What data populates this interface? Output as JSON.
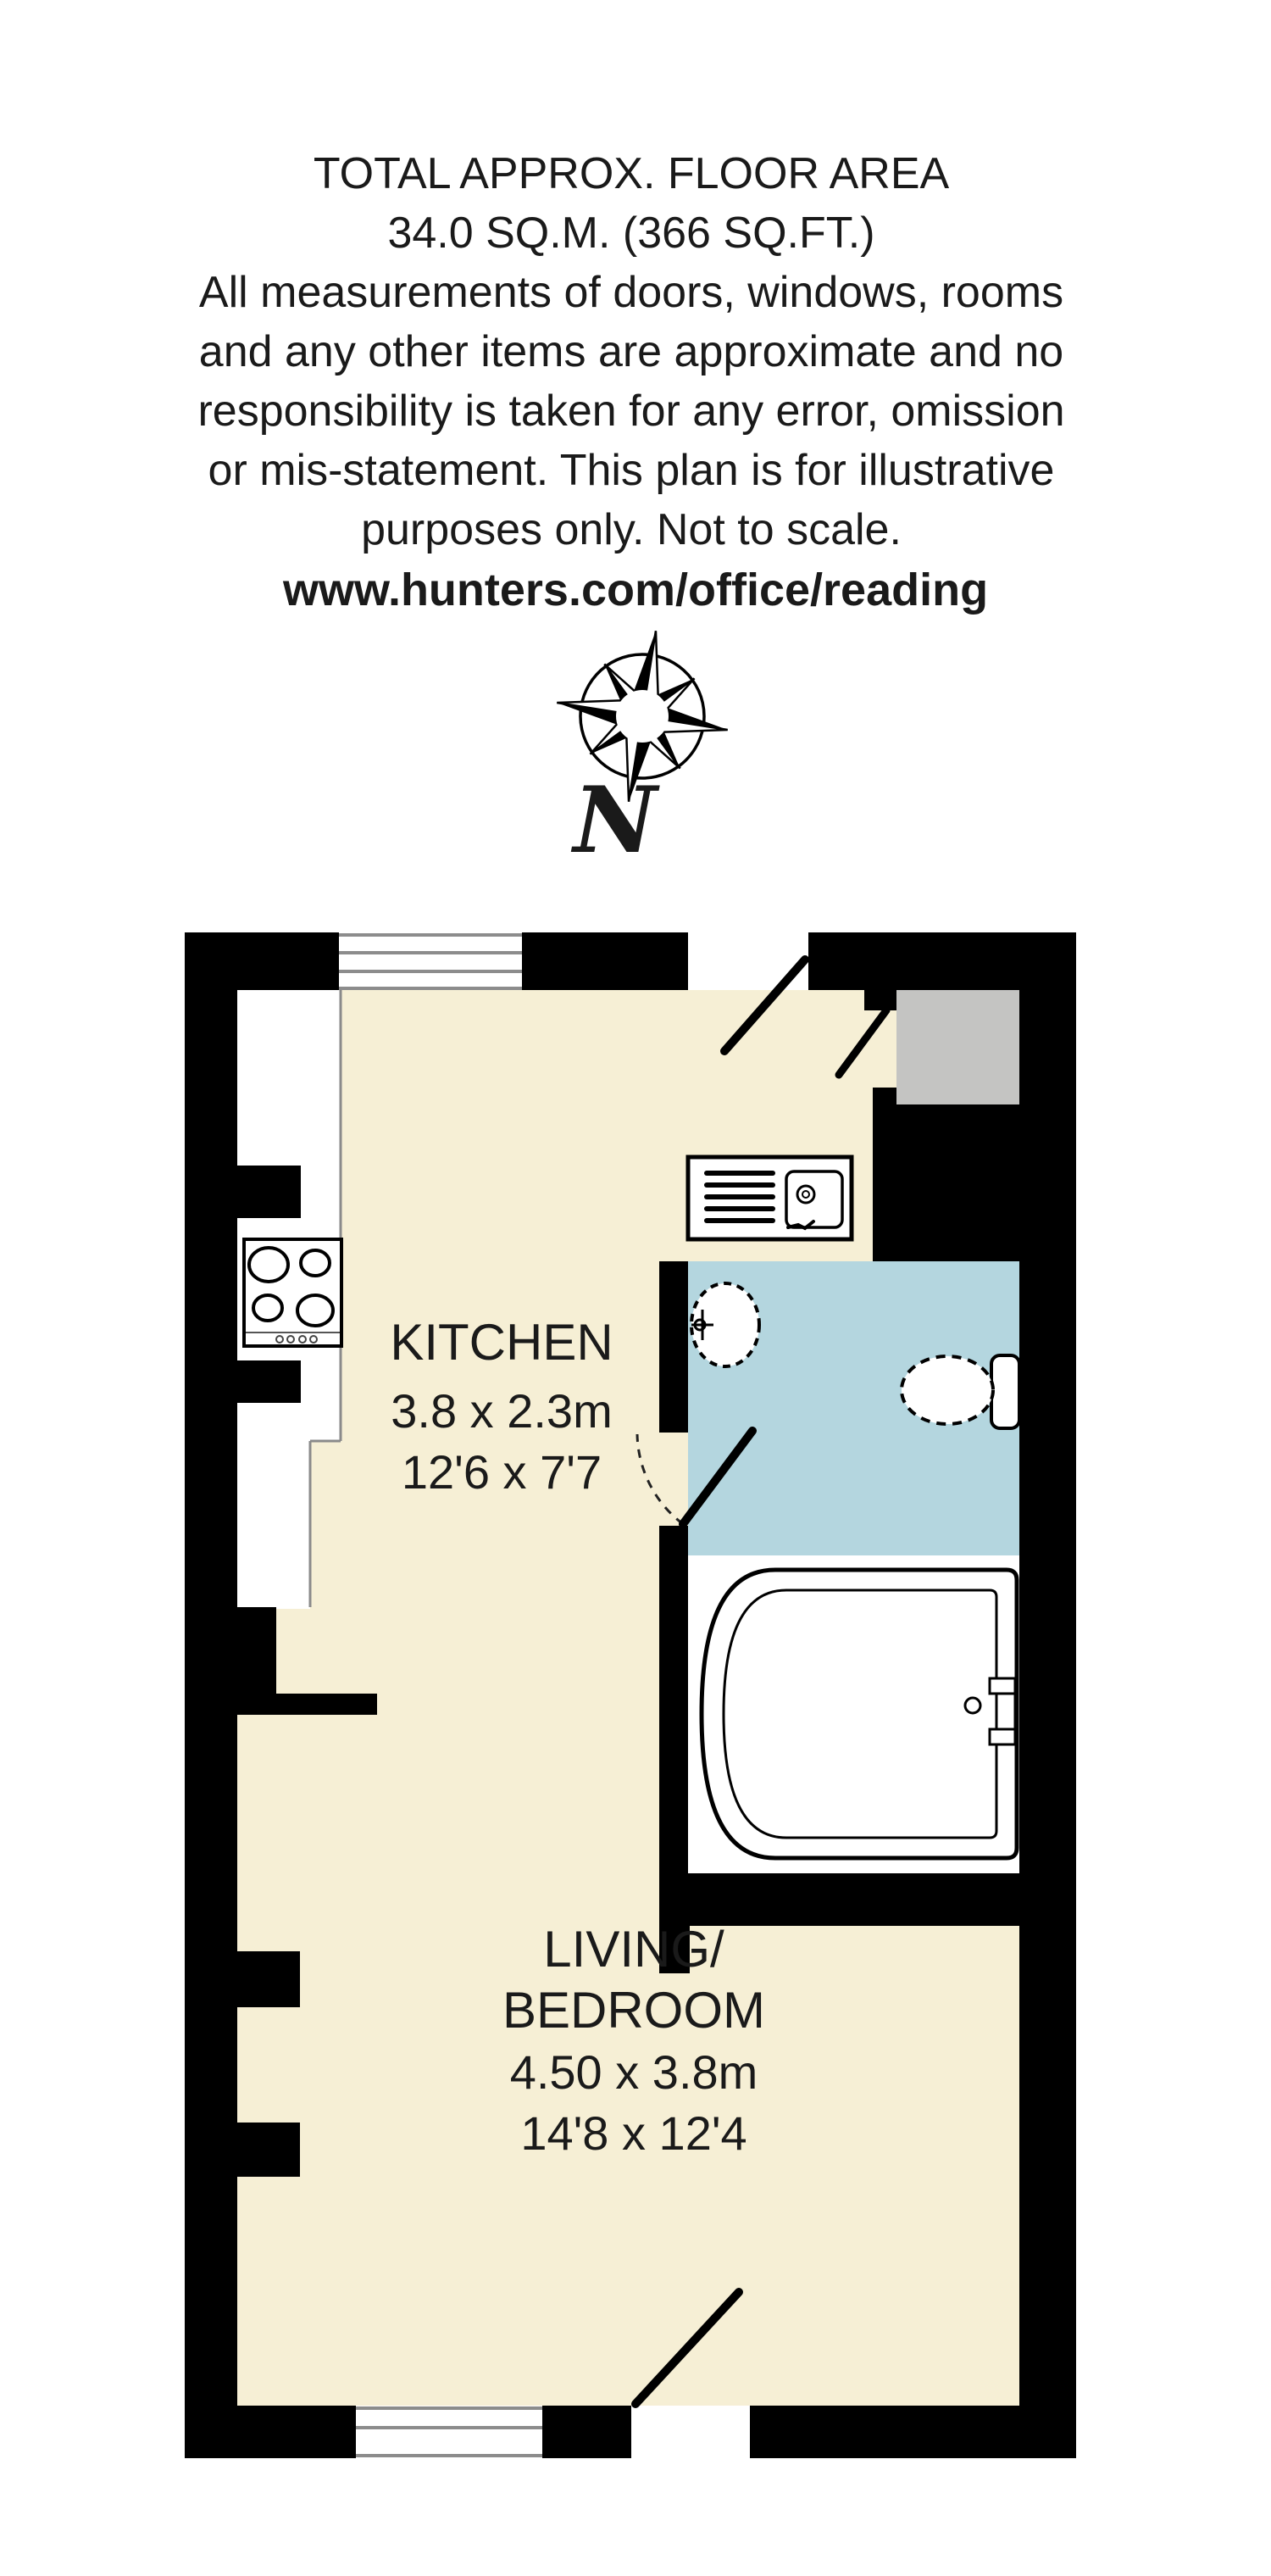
{
  "header": {
    "line1": "TOTAL APPROX. FLOOR AREA",
    "line2": "34.0 SQ.M. (366 SQ.FT.)",
    "disclaimer": [
      "All measurements of doors, windows, rooms",
      "and any other items are approximate and no",
      "responsibility is taken for any error, omission",
      "or mis-statement. This plan is for illustrative",
      "purposes only. Not to scale."
    ],
    "website": "www.hunters.com/office/reading"
  },
  "compass": {
    "north_label": "N"
  },
  "rooms": {
    "kitchen": {
      "name": "KITCHEN",
      "size_metric": "3.8 x 2.3m",
      "size_imperial": "12'6 x 7'7"
    },
    "living_bedroom": {
      "name_line1": "LIVING/",
      "name_line2": "BEDROOM",
      "size_metric": "4.50 x 3.8m",
      "size_imperial": "14'8 x 12'4"
    }
  },
  "colors": {
    "background": "#FFFFFF",
    "wall": "#000000",
    "floor": "#F6EFD5",
    "bathroom_floor": "#B4D6DF",
    "cupboard": "#C4C4C2",
    "window_line": "#8C8C8C",
    "fixture_fill": "#FFFFFF"
  }
}
